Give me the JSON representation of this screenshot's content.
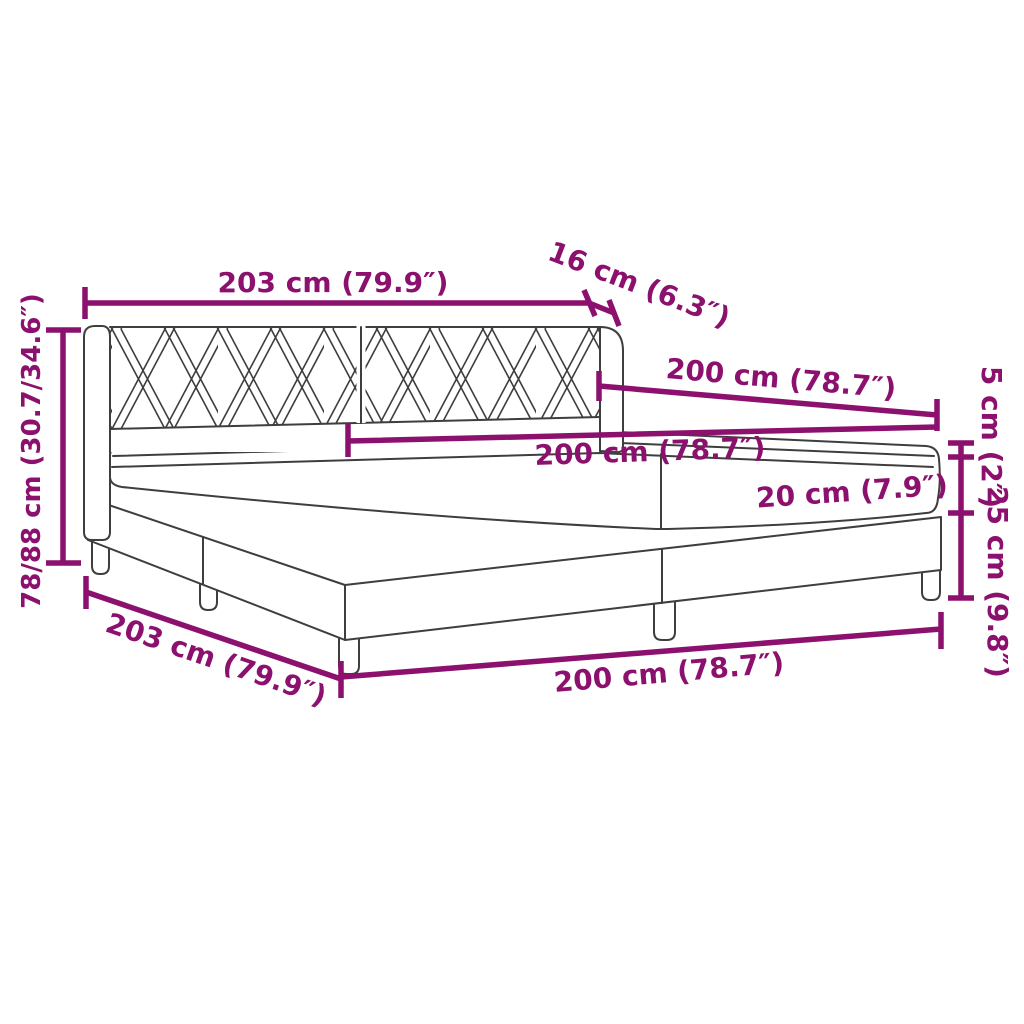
{
  "diagram": {
    "subject": "box spring bed with headboard and mattress - dimension drawing",
    "colors": {
      "accent": "#8C116F",
      "line_art": "#3E3E3E",
      "background": "#FFFFFF"
    },
    "labels": {
      "top_width": "203 cm (79.9″)",
      "headboard_depth": "16 cm (6.3″)",
      "upper_length": "200 cm (78.7″)",
      "mattress_length": "200 cm (78.7″)",
      "mattress_height": "20 cm (7.9″)",
      "topper_height": "5 cm (2″)",
      "base_height": "25 cm (9.8″)",
      "total_height": "78/88 cm (30.7/34.6″)",
      "bottom_width": "203 cm (79.9″)",
      "bottom_length": "200 cm (78.7″)"
    }
  }
}
